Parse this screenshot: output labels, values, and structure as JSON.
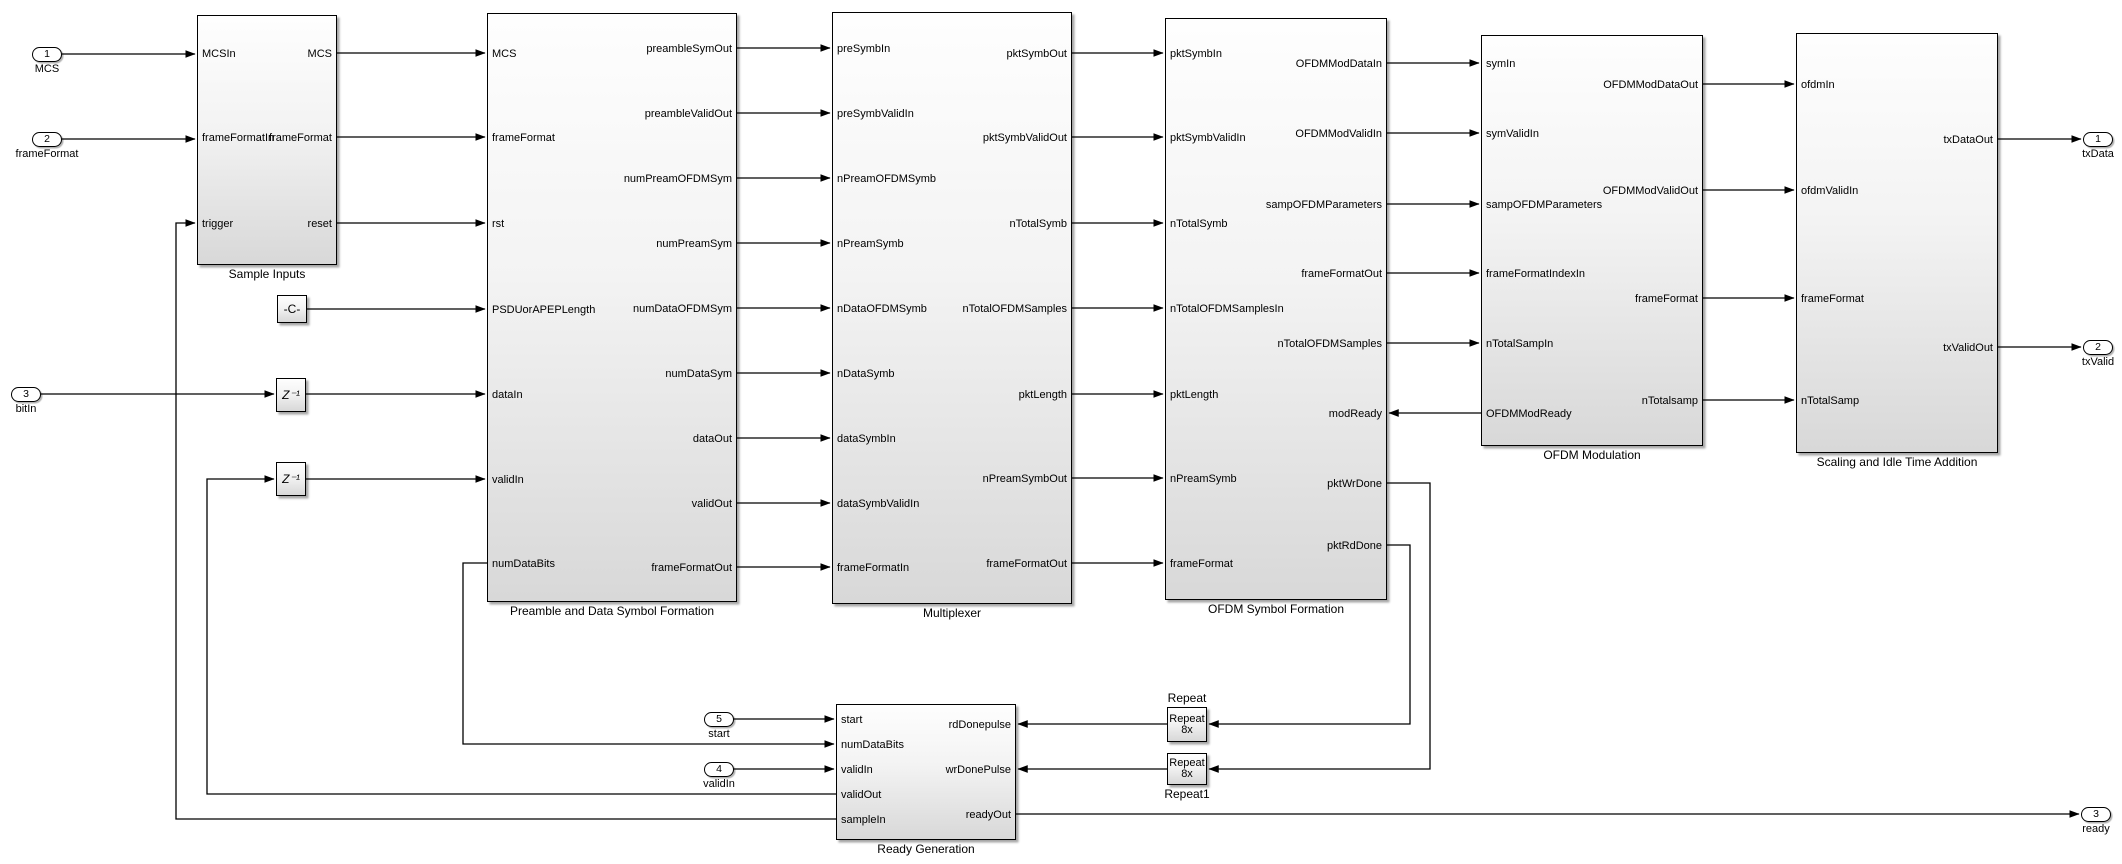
{
  "colors": {
    "background": "#ffffff",
    "wire": "#000000",
    "block_border": "#000000",
    "block_fill_top": "#fefefe",
    "block_fill_bottom": "#d8d8d8"
  },
  "inports": [
    {
      "num": "1",
      "label": "MCS"
    },
    {
      "num": "2",
      "label": "frameFormat"
    },
    {
      "num": "3",
      "label": "bitIn"
    },
    {
      "num": "5",
      "label": "start"
    },
    {
      "num": "4",
      "label": "validIn"
    }
  ],
  "outports": [
    {
      "num": "1",
      "label": "txData"
    },
    {
      "num": "2",
      "label": "txValid"
    },
    {
      "num": "3",
      "label": "ready"
    }
  ],
  "blocks": {
    "sample_inputs": {
      "name": "Sample Inputs",
      "left_ports": [
        "MCSIn",
        "frameFormatIn",
        "trigger"
      ],
      "right_ports": [
        "MCS",
        "frameFormat",
        "reset"
      ]
    },
    "preamble": {
      "name": "Preamble and Data Symbol Formation",
      "left_ports": [
        "MCS",
        "frameFormat",
        "rst",
        "PSDUorAPEPLength",
        "dataIn",
        "validIn",
        "numDataBits"
      ],
      "right_ports": [
        "preambleSymOut",
        "preambleValidOut",
        "numPreamOFDMSym",
        "numPreamSym",
        "numDataOFDMSym",
        "numDataSym",
        "dataOut",
        "validOut",
        "frameFormatOut"
      ]
    },
    "multiplexer": {
      "name": "Multiplexer",
      "left_ports": [
        "preSymbIn",
        "preSymbValidIn",
        "nPreamOFDMSymb",
        "nPreamSymb",
        "nDataOFDMSymb",
        "nDataSymb",
        "dataSymbIn",
        "dataSymbValidIn",
        "frameFormatIn"
      ],
      "right_ports": [
        "pktSymbOut",
        "pktSymbValidOut",
        "nTotalSymb",
        "nTotalOFDMSamples",
        "pktLength",
        "nPreamSymbOut",
        "frameFormatOut"
      ]
    },
    "ofdm_symbol_formation": {
      "name": "OFDM Symbol Formation",
      "left_ports": [
        "pktSymbIn",
        "pktSymbValidIn",
        "nTotalSymb",
        "nTotalOFDMSamplesIn",
        "pktLength",
        "nPreamSymb",
        "frameFormat"
      ],
      "right_ports": [
        "OFDMModDataIn",
        "OFDMModValidIn",
        "sampOFDMParameters",
        "frameFormatOut",
        "nTotalOFDMSamples",
        "modReady",
        "pktWrDone",
        "pktRdDone"
      ]
    },
    "ofdm_modulation": {
      "name": "OFDM Modulation",
      "left_ports": [
        "symIn",
        "symValidIn",
        "sampOFDMParameters",
        "frameFormatIndexIn",
        "nTotalSampIn",
        "OFDMModReady"
      ],
      "right_ports": [
        "OFDMModDataOut",
        "OFDMModValidOut",
        "frameFormat",
        "nTotalsamp"
      ]
    },
    "scaling": {
      "name": "Scaling and Idle Time Addition",
      "left_ports": [
        "ofdmIn",
        "ofdmValidIn",
        "frameFormat",
        "nTotalSamp"
      ],
      "right_ports": [
        "txDataOut",
        "txValidOut"
      ]
    },
    "ready_generation": {
      "name": "Ready Generation",
      "left_ports": [
        "start",
        "numDataBits",
        "validIn",
        "validOut",
        "sampleIn"
      ],
      "right_ports": [
        "rdDonepulse",
        "wrDonePulse",
        "readyOut"
      ]
    },
    "repeat": {
      "name": "Repeat",
      "body_lines": [
        "Repeat",
        "8x"
      ]
    },
    "repeat1": {
      "name": "Repeat1",
      "body_lines": [
        "Repeat",
        "8x"
      ]
    },
    "constant": {
      "body": "-C-"
    },
    "delay1": {
      "body": "Z⁻¹"
    },
    "delay2": {
      "body": "Z⁻¹"
    }
  }
}
